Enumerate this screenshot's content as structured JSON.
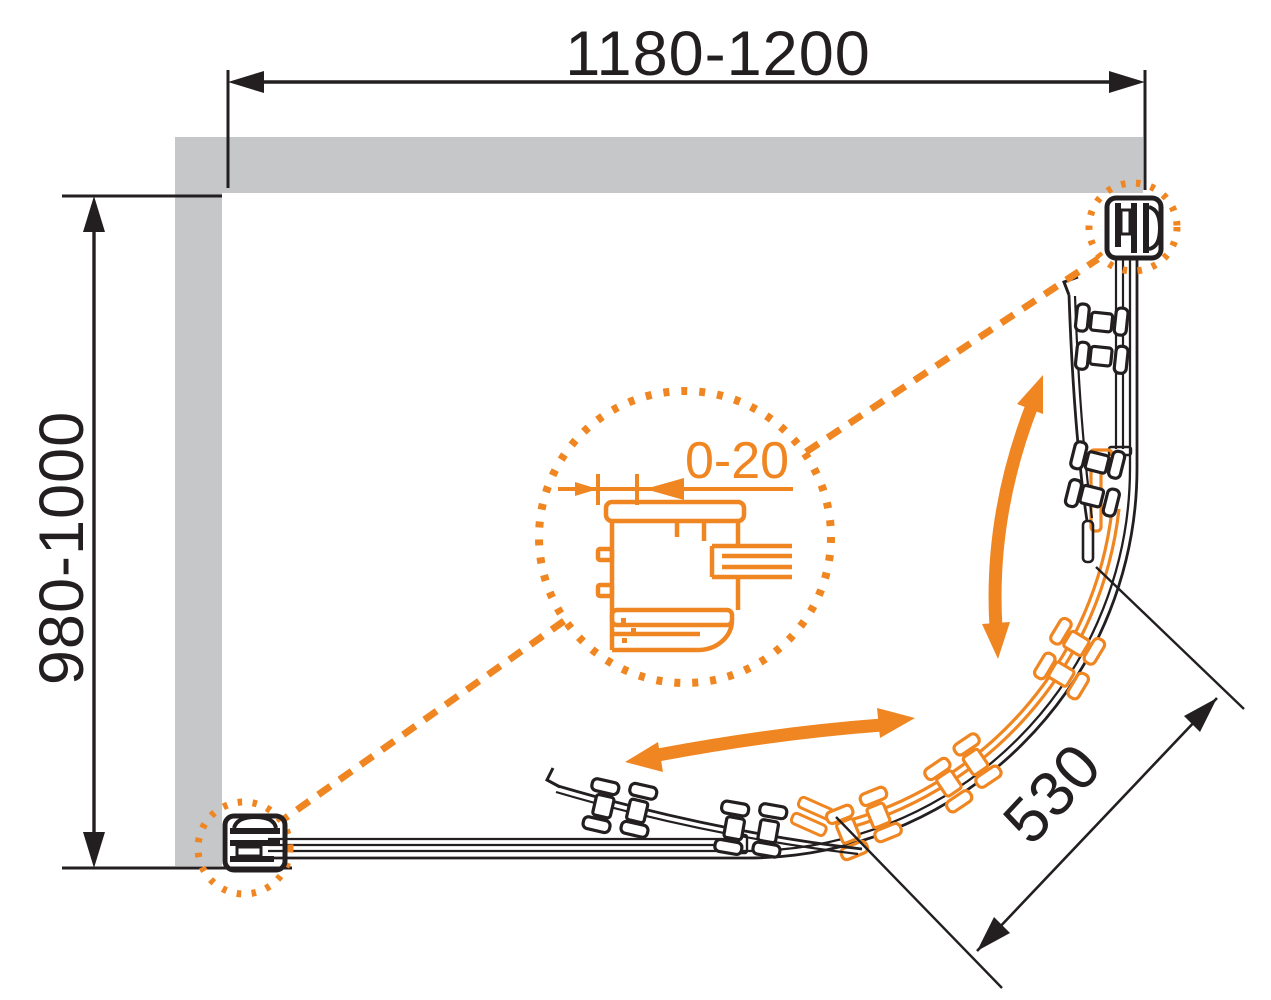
{
  "drawing": {
    "type": "shower-enclosure-plan",
    "labels": {
      "width": "1180-1200",
      "depth": "980-1000",
      "door_opening": "530",
      "wall_adjustment": "0-20"
    },
    "colors": {
      "accent_orange": "#F08621",
      "wall_gray": "#C6C7C9",
      "line_black": "#231F20",
      "background": "#FFFFFF"
    }
  }
}
